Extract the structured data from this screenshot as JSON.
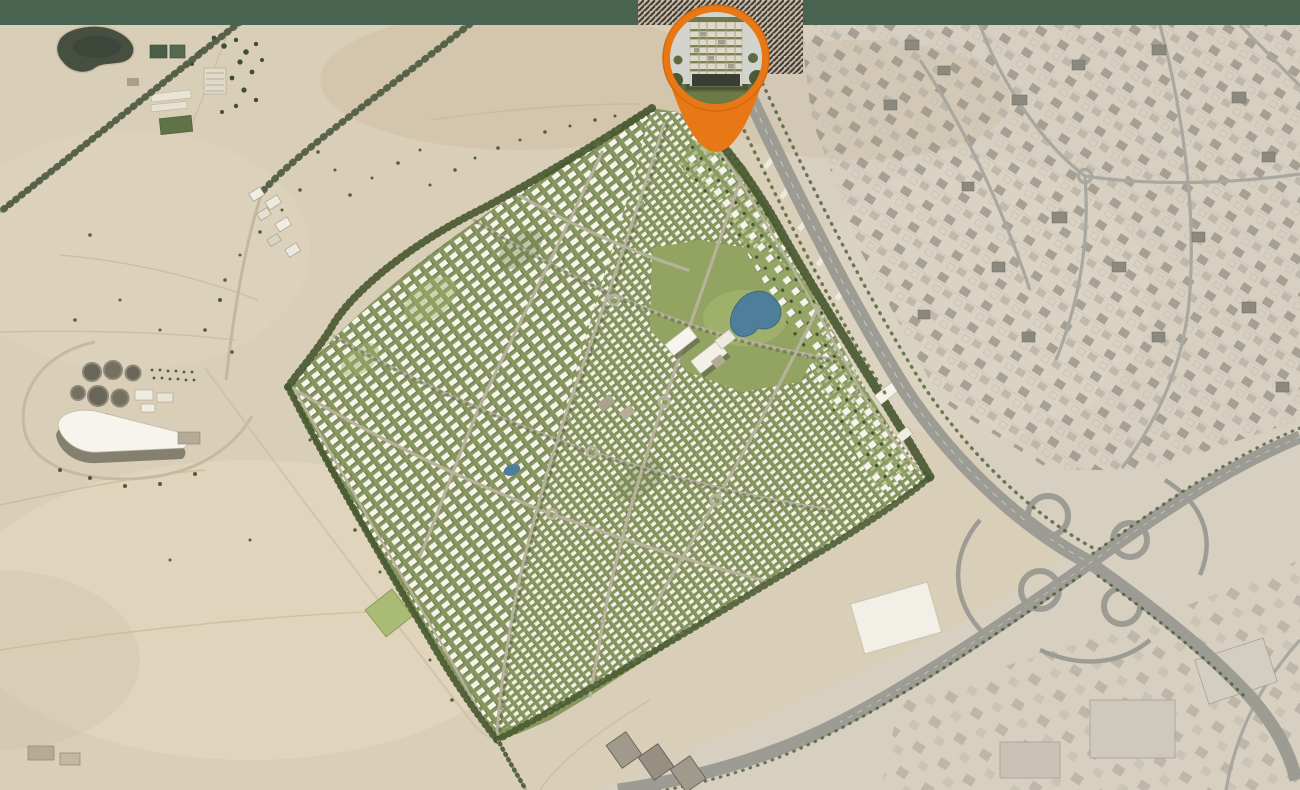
{
  "map": {
    "kind": "satellite-masterplan-location-map",
    "marker": {
      "label": "project-location",
      "photo": "residential-building-render",
      "pin_color": "#e87716",
      "pin_color_dark": "#d6680f"
    },
    "decor": {
      "top_band_color": "#48634f",
      "hatch_stripe_color": "#3f352c",
      "hatch_bg_color": "#c6bdab"
    },
    "palette": {
      "desert": "#d9ceb8",
      "desert_east": "#d7cfc0",
      "dev_green": "#87975f",
      "park_green": "#93a462",
      "lawn_green": "#a2b36e",
      "tree_dark": "#46572f",
      "pond_blue": "#4e7e99",
      "lake_dark": "#474f41",
      "house_white": "#f4f2e9",
      "road_community": "#b7b29c",
      "road_highway": "#9c9c94",
      "road_urban": "#a8a8a0"
    },
    "features": {
      "community": "villa-master-community",
      "water": [
        "lake",
        "community-pond",
        "small-pond"
      ],
      "infrastructure": [
        "tree-lined-roads",
        "highway",
        "cloverleaf-interchange",
        "water-treatment-plant",
        "farms",
        "urban-district",
        "warehouses"
      ]
    }
  }
}
